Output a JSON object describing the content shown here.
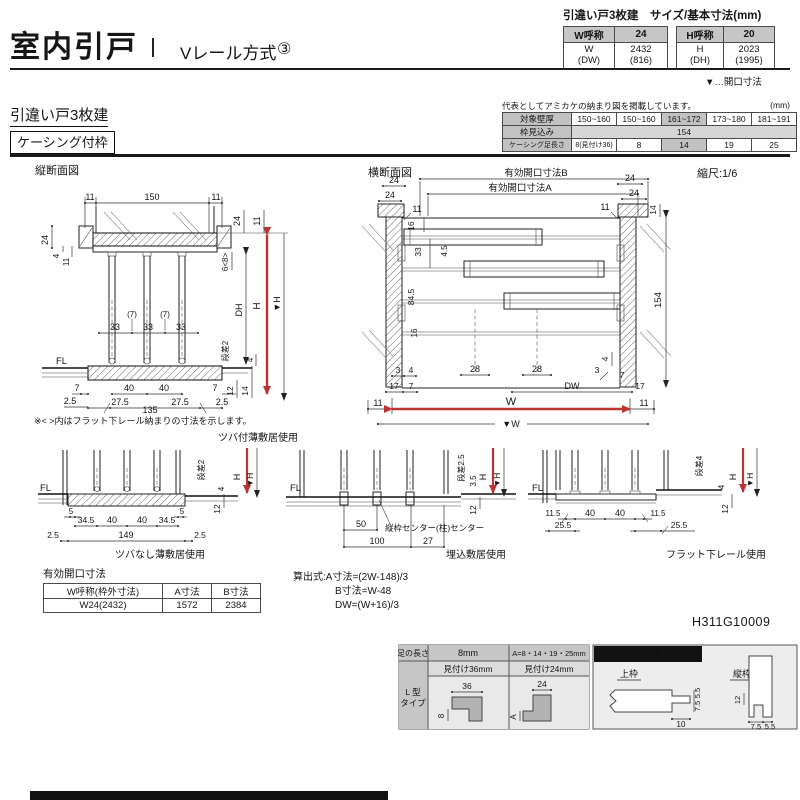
{
  "colors": {
    "accent_red": "#bb3333",
    "header_grey": "#c6c6c6",
    "shade_grey": "#c2c2c2",
    "light_grey": "#d6d6d6"
  },
  "header": {
    "title": "室内引戸",
    "method": "Vレール方式",
    "number": "③"
  },
  "size_table": {
    "title": "引違い戸3枚建　サイズ/基本寸法(mm)",
    "w_name": "W呼称",
    "w_val": "24",
    "h_name": "H呼称",
    "h_val": "20",
    "w_sub1": "W",
    "w_sub2": "(DW)",
    "w_dim1": "2432",
    "w_dim2": "(816)",
    "h_sub1": "H",
    "h_sub2": "(DH)",
    "h_dim1": "2023",
    "h_dim2": "(1995)",
    "note": "▼…開口寸法"
  },
  "section": {
    "series": "引違い戸3枚建",
    "frame": "ケーシング付枠"
  },
  "wall_table": {
    "note": "代表としてアミカケの納まり図を掲載しています。",
    "unit": "(mm)",
    "row1_label": "対象壁厚",
    "row1": [
      "150~160",
      "150~160",
      "161~172",
      "173~180",
      "181~191"
    ],
    "row2_label": "枠見込み",
    "row2_value": "154",
    "row3_label": "ケーシング足長さ",
    "row3": [
      "8(見付け36)",
      "8",
      "14",
      "19",
      "25"
    ]
  },
  "vertical_section": {
    "title": "縦断面図",
    "note": "※< >内はフラット下レール納まりの寸法を示します。",
    "caption": "ツバ付薄敷居使用",
    "dims": {
      "top_left_11": "11",
      "top_150": "150",
      "top_right_11": "11",
      "left_24": "24",
      "left_4": "4",
      "left_11": "11",
      "right_24": "24",
      "right_11": "11",
      "right_6_8": "6<8>",
      "dh": "DH",
      "h": "H",
      "h_datum": "▼H",
      "mid_33a": "33",
      "mid_7a": "(7)",
      "mid_33b": "33",
      "mid_7b": "(7)",
      "mid_33c": "33",
      "fl": "FL",
      "step": "段差2",
      "step_4": "4",
      "bot_7l": "7",
      "bot_25l": "2.5",
      "bot_40a": "40",
      "bot_40b": "40",
      "bot_275a": "27.5",
      "bot_135": "135",
      "bot_275b": "27.5",
      "bot_7r": "7",
      "bot_25r": "2.5",
      "right_12": "12",
      "right_14": "14"
    }
  },
  "horizontal_section": {
    "title": "横断面図",
    "scale": "縮尺:1/6",
    "dims": {
      "open_b": "有効開口寸法B",
      "open_a": "有効開口寸法A",
      "tl_24a": "24",
      "tl_24b": "24",
      "tl_11": "11",
      "tr_24a": "24",
      "tr_24b": "24",
      "tr_11": "11",
      "tr_14": "14",
      "l_16a": "16",
      "l_33": "33",
      "l_45": "4.5",
      "l_845": "84.5",
      "l_16b": "16",
      "r_154": "154",
      "bl_3": "3",
      "bl_4": "4",
      "bl_17": "17",
      "bl_7": "7",
      "c_28a": "28",
      "c_28b": "28",
      "dw": "DW",
      "br_4": "4",
      "br_3": "3",
      "br_7": "7",
      "br_17": "17",
      "w11_l": "11",
      "w11_r": "11",
      "w": "W",
      "w_datum": "▼W"
    }
  },
  "details": [
    {
      "caption": "ツバなし薄敷居使用",
      "fl": "FL",
      "step": "段差2",
      "drop": "4",
      "h": "H",
      "h_datum": "▼H",
      "d12": "12",
      "d5l": "5",
      "d345l": "34.5",
      "d40a": "40",
      "d40b": "40",
      "d345r": "34.5",
      "d5r": "5",
      "e25l": "2.5",
      "e149": "149",
      "e25r": "2.5"
    },
    {
      "caption": "埋込敷居使用",
      "fl": "FL",
      "step": "段差2.5",
      "drop": "3.5",
      "h": "H",
      "h_datum": "▼H",
      "d12": "12",
      "d50": "50",
      "center_note": "縦枠センター(柱)センター",
      "e100": "100",
      "e27": "27"
    },
    {
      "caption": "フラット下レール使用",
      "fl": "FL",
      "step": "段差4",
      "drop": "4",
      "h": "H",
      "h_datum": "▼H",
      "d12": "12",
      "d115l": "11.5",
      "d40a": "40",
      "d40b": "40",
      "d115r": "11.5",
      "e255l": "25.5",
      "e255r": "25.5"
    }
  ],
  "opening_table": {
    "title": "有効開口寸法",
    "h1": "W呼称(枠外寸法)",
    "h2": "A寸法",
    "h3": "B寸法",
    "v1": "W24(2432)",
    "v2": "1572",
    "v3": "2384"
  },
  "formulas": {
    "line1": "算出式:A寸法=(2W-148)/3",
    "line2": "B寸法=W-48",
    "line3": "DW=(W+16)/3"
  },
  "doc_number": "H311G10009",
  "leg_section": {
    "col0_header": "足の長さ",
    "col1_header": "8mm",
    "col2_header": "A=8・14・19・25mm",
    "col1_sub": "見付け36mm",
    "col2_sub": "見付け24mm",
    "type_line1": "L 型",
    "type_line2": "タイプ",
    "p1_top": "36",
    "p1_left": "8",
    "p2_top": "24",
    "p2_left": "A",
    "detail_title": "枠ケーシング溝詳細図",
    "upper_label": "上枠",
    "side_label": "縦枠",
    "u_55": "5.5",
    "u_75": "7.5",
    "u_10": "10",
    "s_12": "12",
    "s_75": "7.5",
    "s_55": "5.5"
  }
}
